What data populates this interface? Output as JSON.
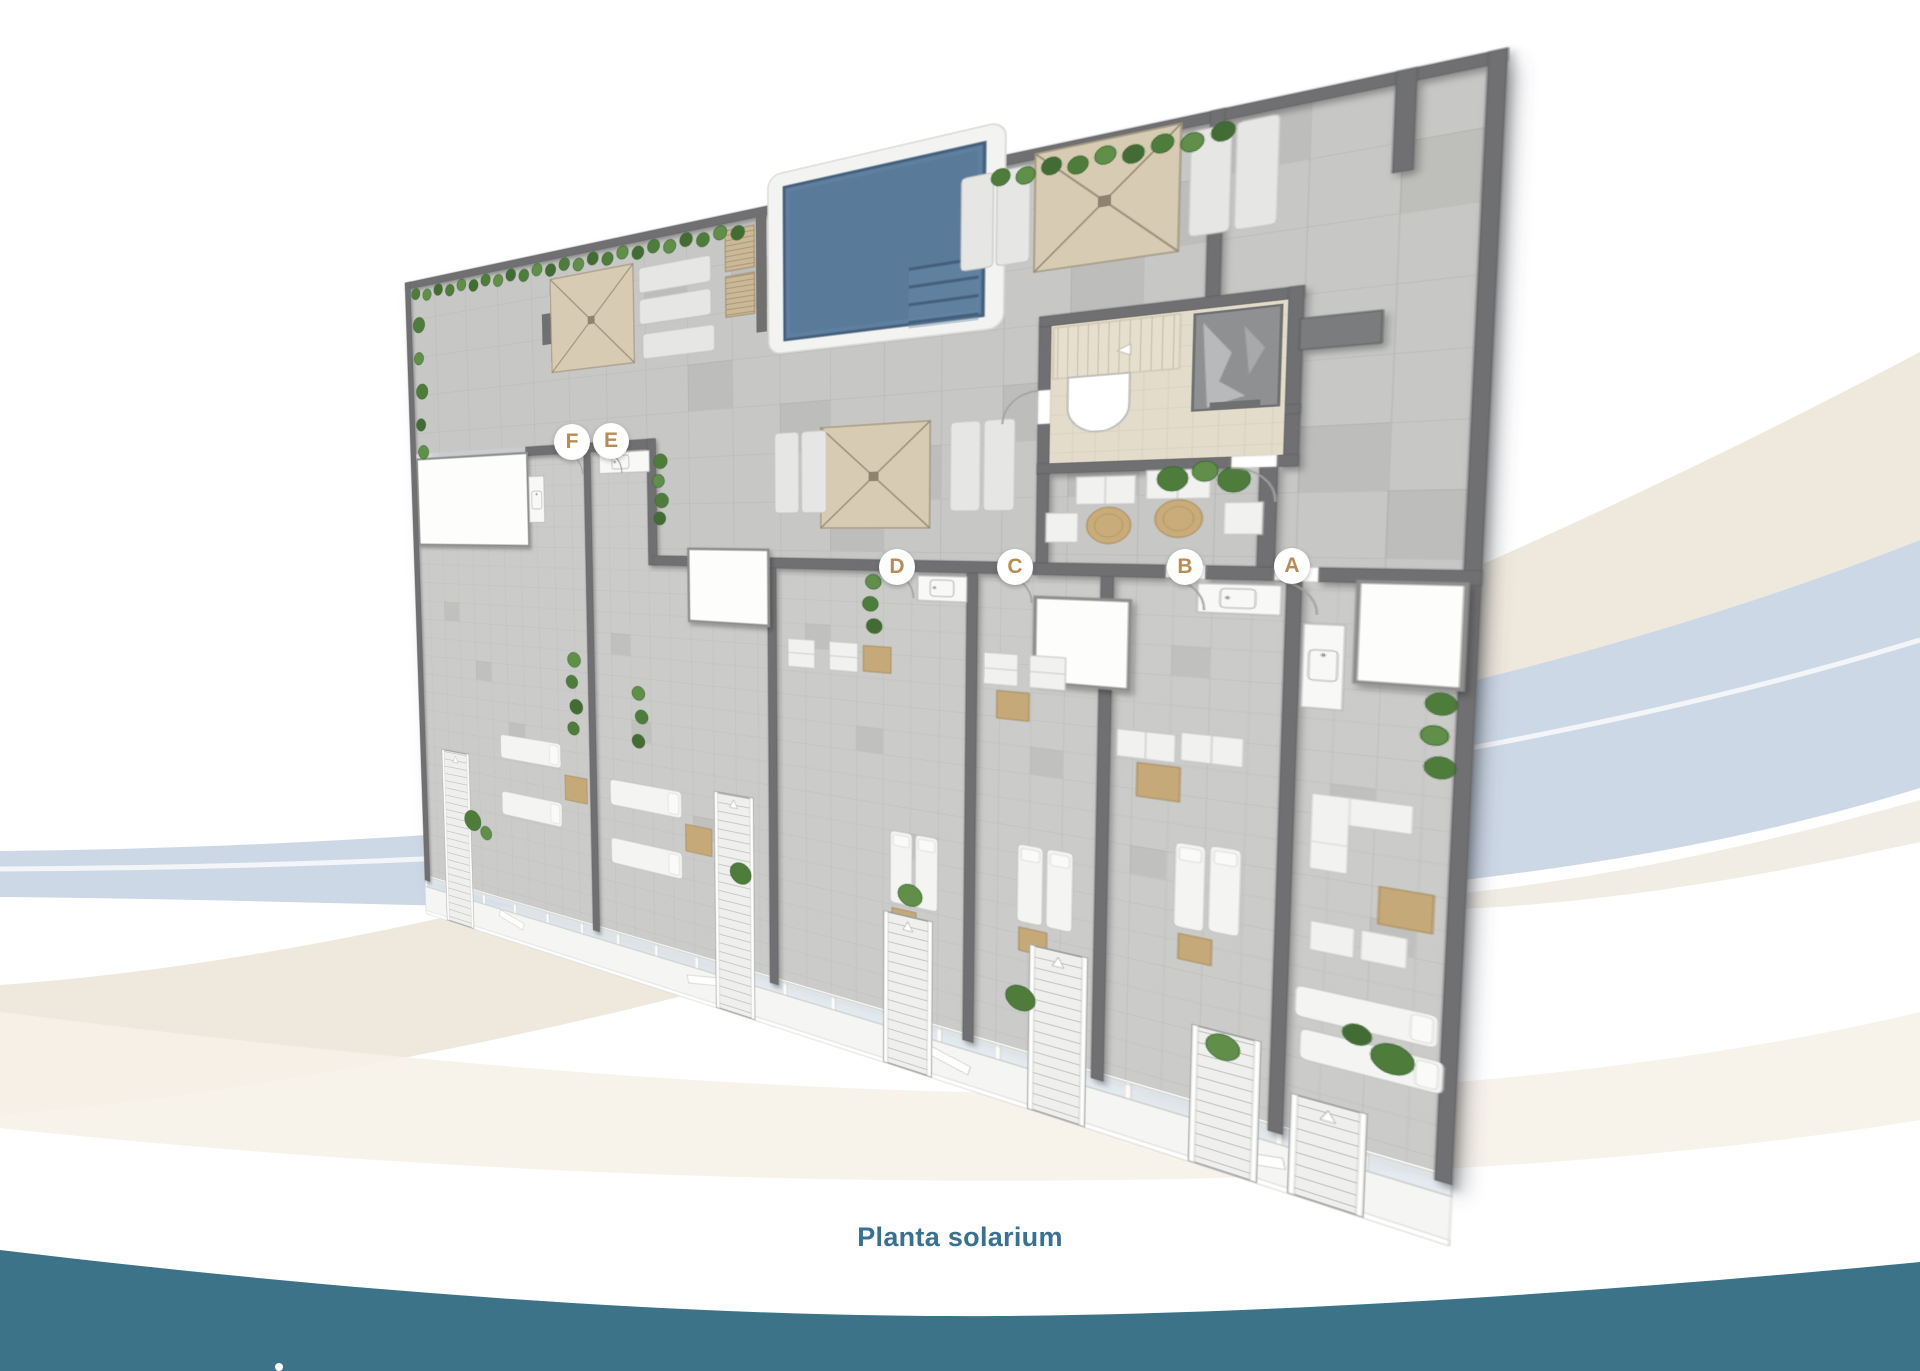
{
  "page": {
    "background": "#ffffff",
    "type": "real-estate floor plan brochure page"
  },
  "caption": {
    "text": "Planta solarium",
    "color": "#3a7090"
  },
  "units": [
    {
      "letter": "F"
    },
    {
      "letter": "E"
    },
    {
      "letter": "D"
    },
    {
      "letter": "C"
    },
    {
      "letter": "B"
    },
    {
      "letter": "A"
    }
  ],
  "plan": {
    "features": [
      "swimming-pool",
      "pergola",
      "sun-lounger",
      "outdoor-shower-deck",
      "stair-lobby",
      "elevator",
      "private-terrace",
      "terrace-staircase",
      "outdoor-kitchenette",
      "planter-hedge",
      "glass-railing",
      "door-swing",
      "round-table",
      "l-shaped-sofa"
    ],
    "colors": {
      "pool_water": "#5e7f9f",
      "pool_deck": "#f3f3f1",
      "wall": "#6f7072",
      "tile_communal": "#c7c7c5",
      "tile_terrace": "#cbcbc9",
      "lobby_floor": "#e4dcca",
      "pergola_canvas": "#d7ccb3",
      "hedge_green": "#4e7c3b",
      "furniture_tan": "#c6a978",
      "unit_label_letter": "#b68c56",
      "bottom_wave_teal": "#3c7389",
      "ribbon_blue": "#cdd8e6",
      "ribbon_beige": "#efe9dd"
    }
  }
}
